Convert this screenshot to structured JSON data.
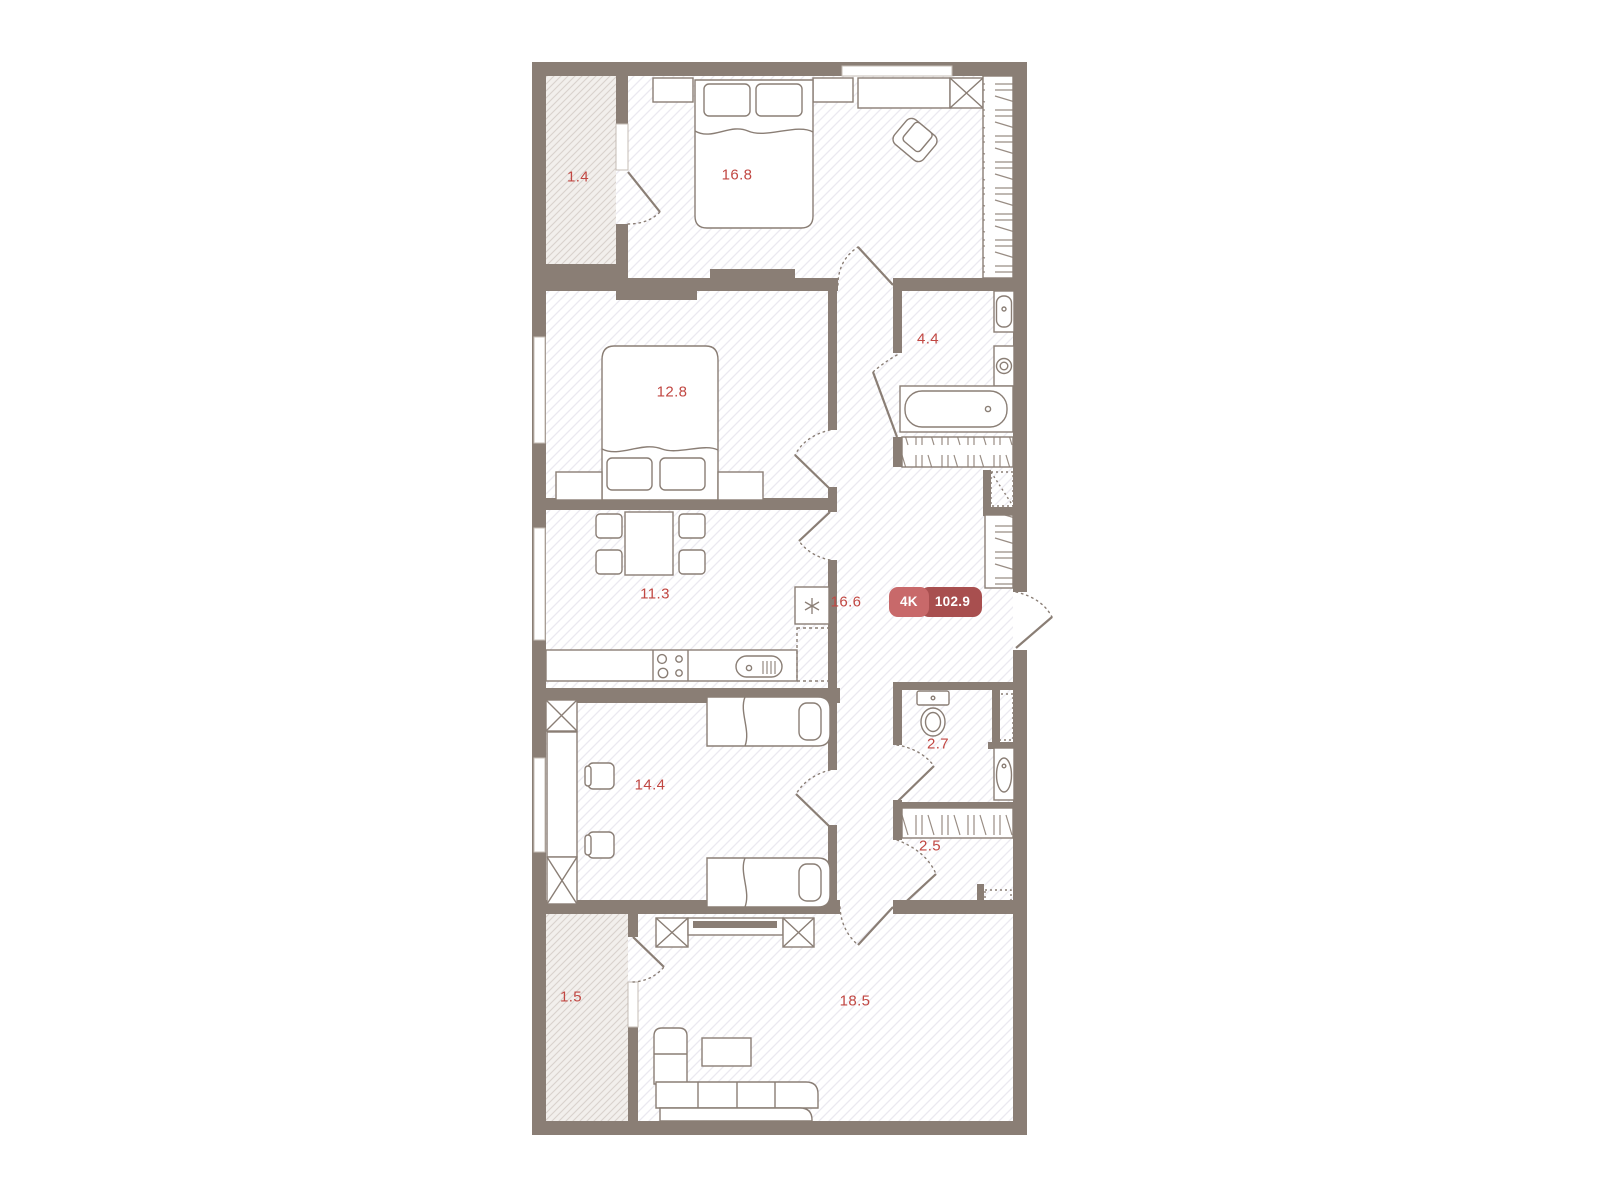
{
  "badge": {
    "type_label": "4K",
    "total_area": "102.9"
  },
  "rooms": {
    "balcony_top": {
      "area": "1.4"
    },
    "bedroom_main": {
      "area": "16.8"
    },
    "bathroom": {
      "area": "4.4"
    },
    "bedroom_second": {
      "area": "12.8"
    },
    "kitchen": {
      "area": "11.3"
    },
    "hallway": {
      "area": "16.6"
    },
    "wc": {
      "area": "2.7"
    },
    "children_room": {
      "area": "14.4"
    },
    "storage": {
      "area": "2.5"
    },
    "living_room": {
      "area": "18.5"
    },
    "balcony_bottom": {
      "area": "1.5"
    }
  },
  "colors": {
    "wall": "#8a7e75",
    "label": "#c14742",
    "badge_type_bg": "#c8696a",
    "badge_area_bg": "#a84f4f",
    "room_hatch": "#ebe9f0",
    "balcony_bg": "#f2efec",
    "balcony_hatch": "#d9d2cd"
  },
  "icons": {
    "snowflake-icon": "refrigerator",
    "stove-burners-icon": "cooktop",
    "washing-machine-icon": "washer",
    "sink-icon": "sink",
    "toilet-icon": "toilet",
    "bathtub-icon": "bathtub"
  }
}
